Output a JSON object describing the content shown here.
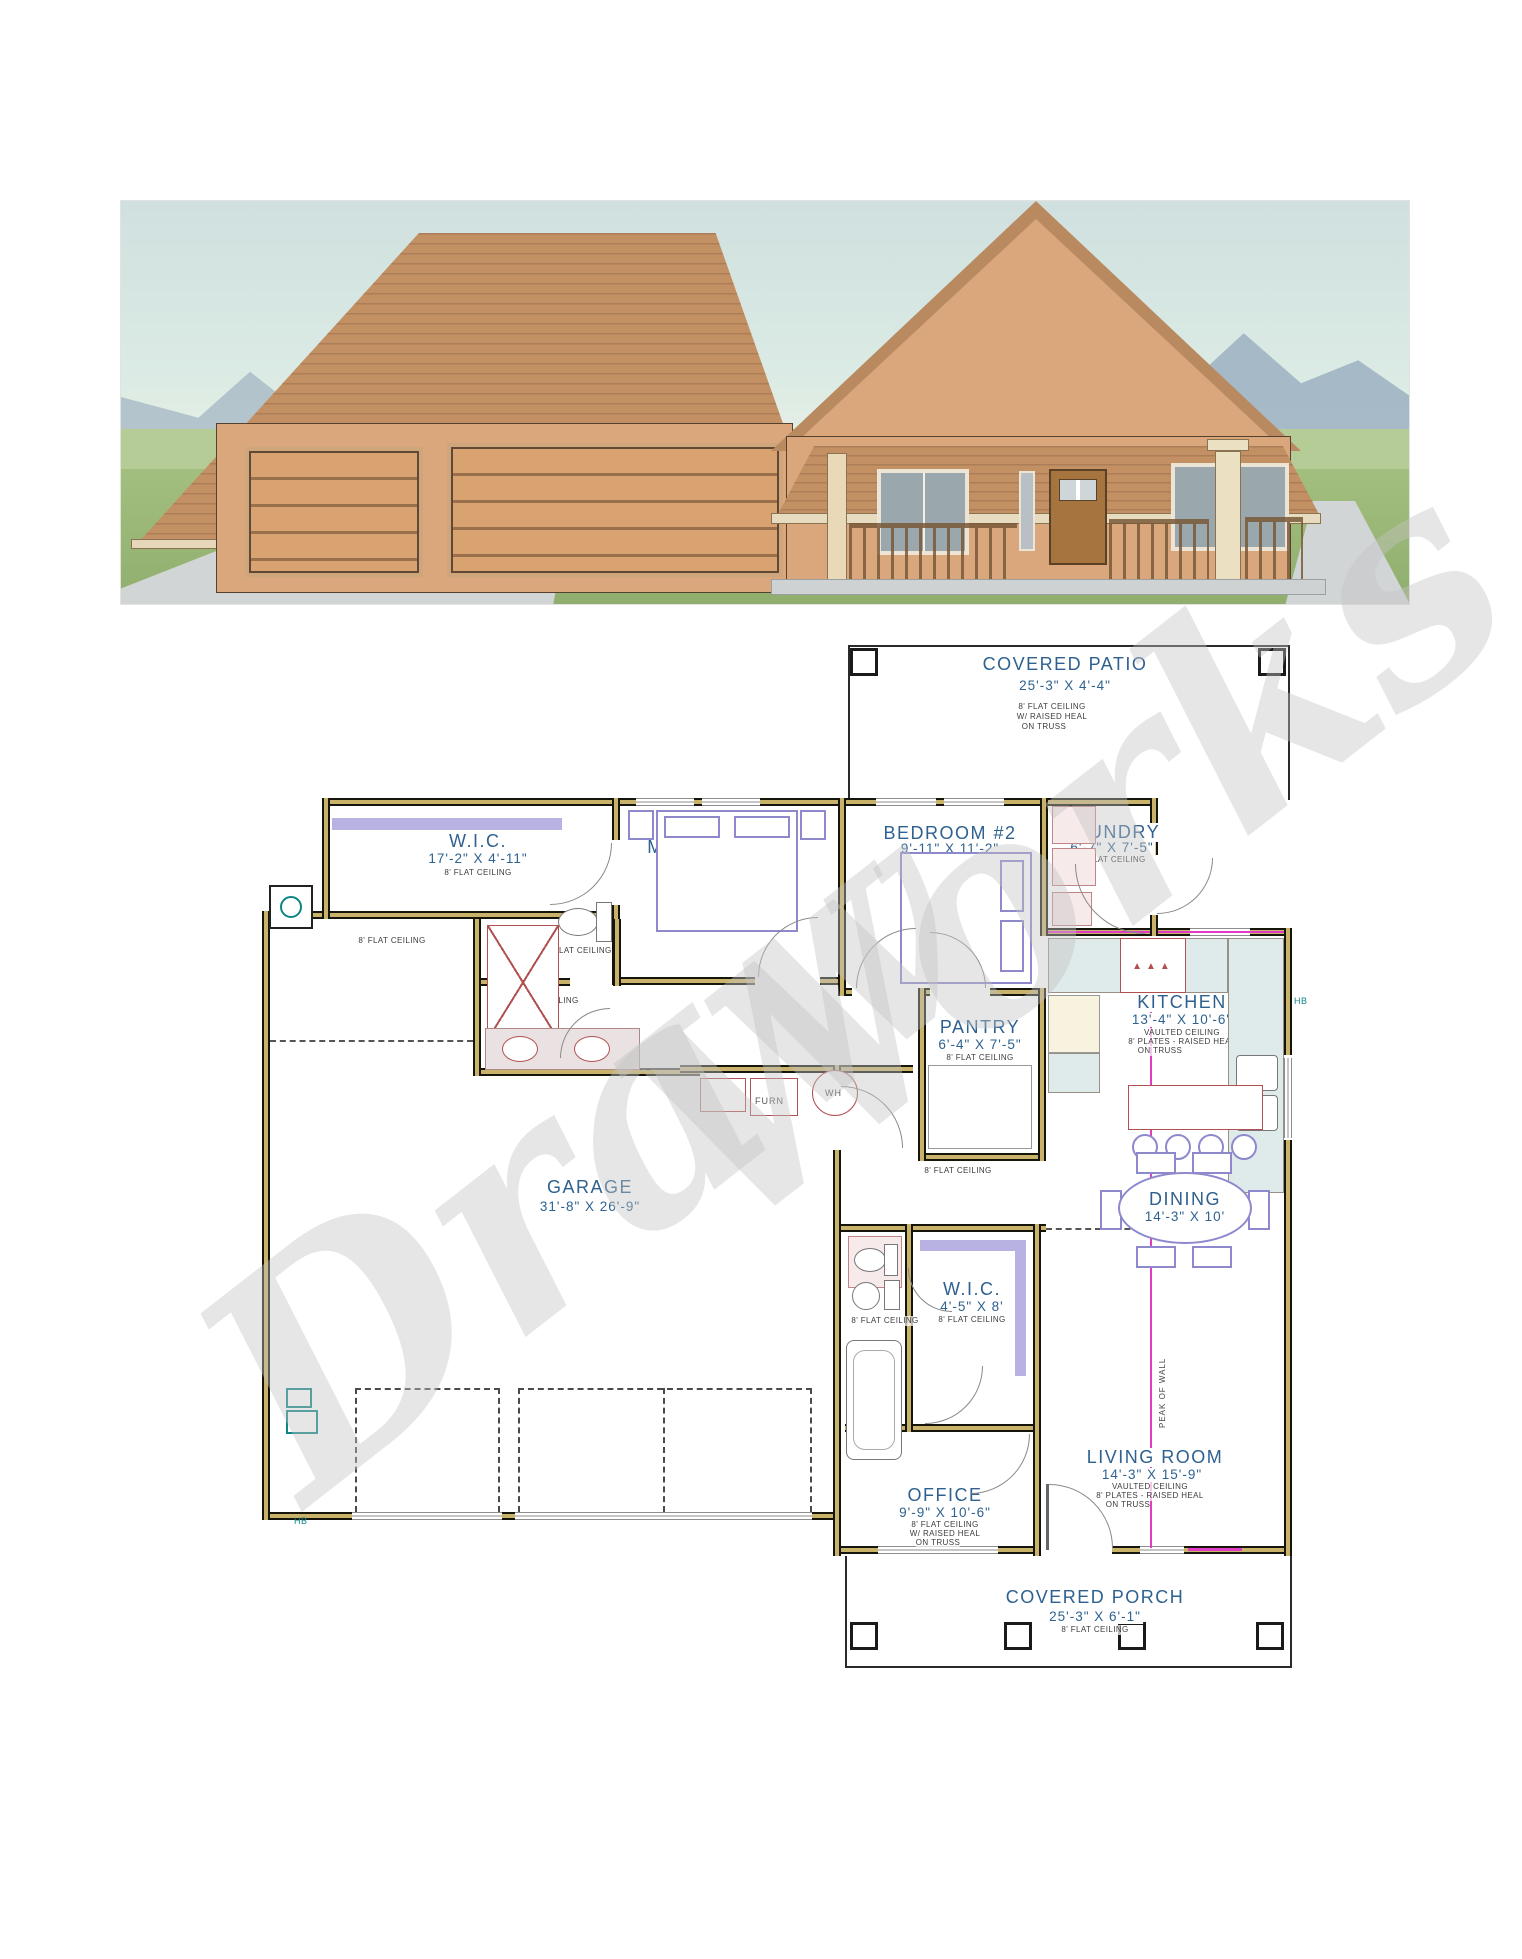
{
  "watermark": {
    "word1": "Draw",
    "word2": "Works"
  },
  "rooms": {
    "covered_patio": {
      "name": "COVERED PATIO",
      "dims": "25'-3\" X 4'-4\""
    },
    "wic_master": {
      "name": "W.I.C.",
      "dims": "17'-2\" X 4'-11\""
    },
    "master_bdrm": {
      "name": "MASTER BDRM",
      "dims": "12' X 15'-7\""
    },
    "bedroom2": {
      "name": "BEDROOM #2",
      "dims": "9'-11\" X 11'-2\""
    },
    "laundry": {
      "name": "LAUNDRY",
      "dims": "6'-7\" X 7'-5\""
    },
    "kitchen": {
      "name": "KITCHEN",
      "dims": "13'-4\" X 10'-6\""
    },
    "pantry": {
      "name": "PANTRY",
      "dims": "6'-4\" X 7'-5\""
    },
    "garage": {
      "name": "GARAGE",
      "dims": "31'-8\" X 26'-9\""
    },
    "dining": {
      "name": "DINING",
      "dims": "14'-3\" X 10'"
    },
    "wic2": {
      "name": "W.I.C.",
      "dims": "4'-5\" X 8'"
    },
    "living_room": {
      "name": "LIVING ROOM",
      "dims": "14'-3\" X 15'-9\""
    },
    "office": {
      "name": "OFFICE",
      "dims": "9'-9\" X 10'-6\""
    },
    "covered_porch": {
      "name": "COVERED PORCH",
      "dims": "25'-3\" X 6'-1\""
    }
  },
  "ceiling_notes": {
    "flat8": "8' FLAT CEILING",
    "raised_heal": "W/ RAISED HEAL",
    "on_truss": "ON TRUSS",
    "vaulted": "VAULTED CEILING",
    "plates8": "8' PLATES - RAISED HEAL"
  },
  "fixtures": {
    "furnace": "FURN",
    "water_heater": "WH",
    "hose_bib": "HB",
    "peak_of_wall": "PEAK OF WALL"
  },
  "colors": {
    "label_blue": "#2e618f",
    "wall_tan": "#c9b26a",
    "magenta": "#e23bc4",
    "teal": "#0e8585",
    "watermark_gray": "#c4c4c4",
    "roof_brown": "#c39064",
    "stucco_tan": "#daa67c",
    "grass_green": "#a3bf7f",
    "sky_blue": "#cfe0df"
  }
}
